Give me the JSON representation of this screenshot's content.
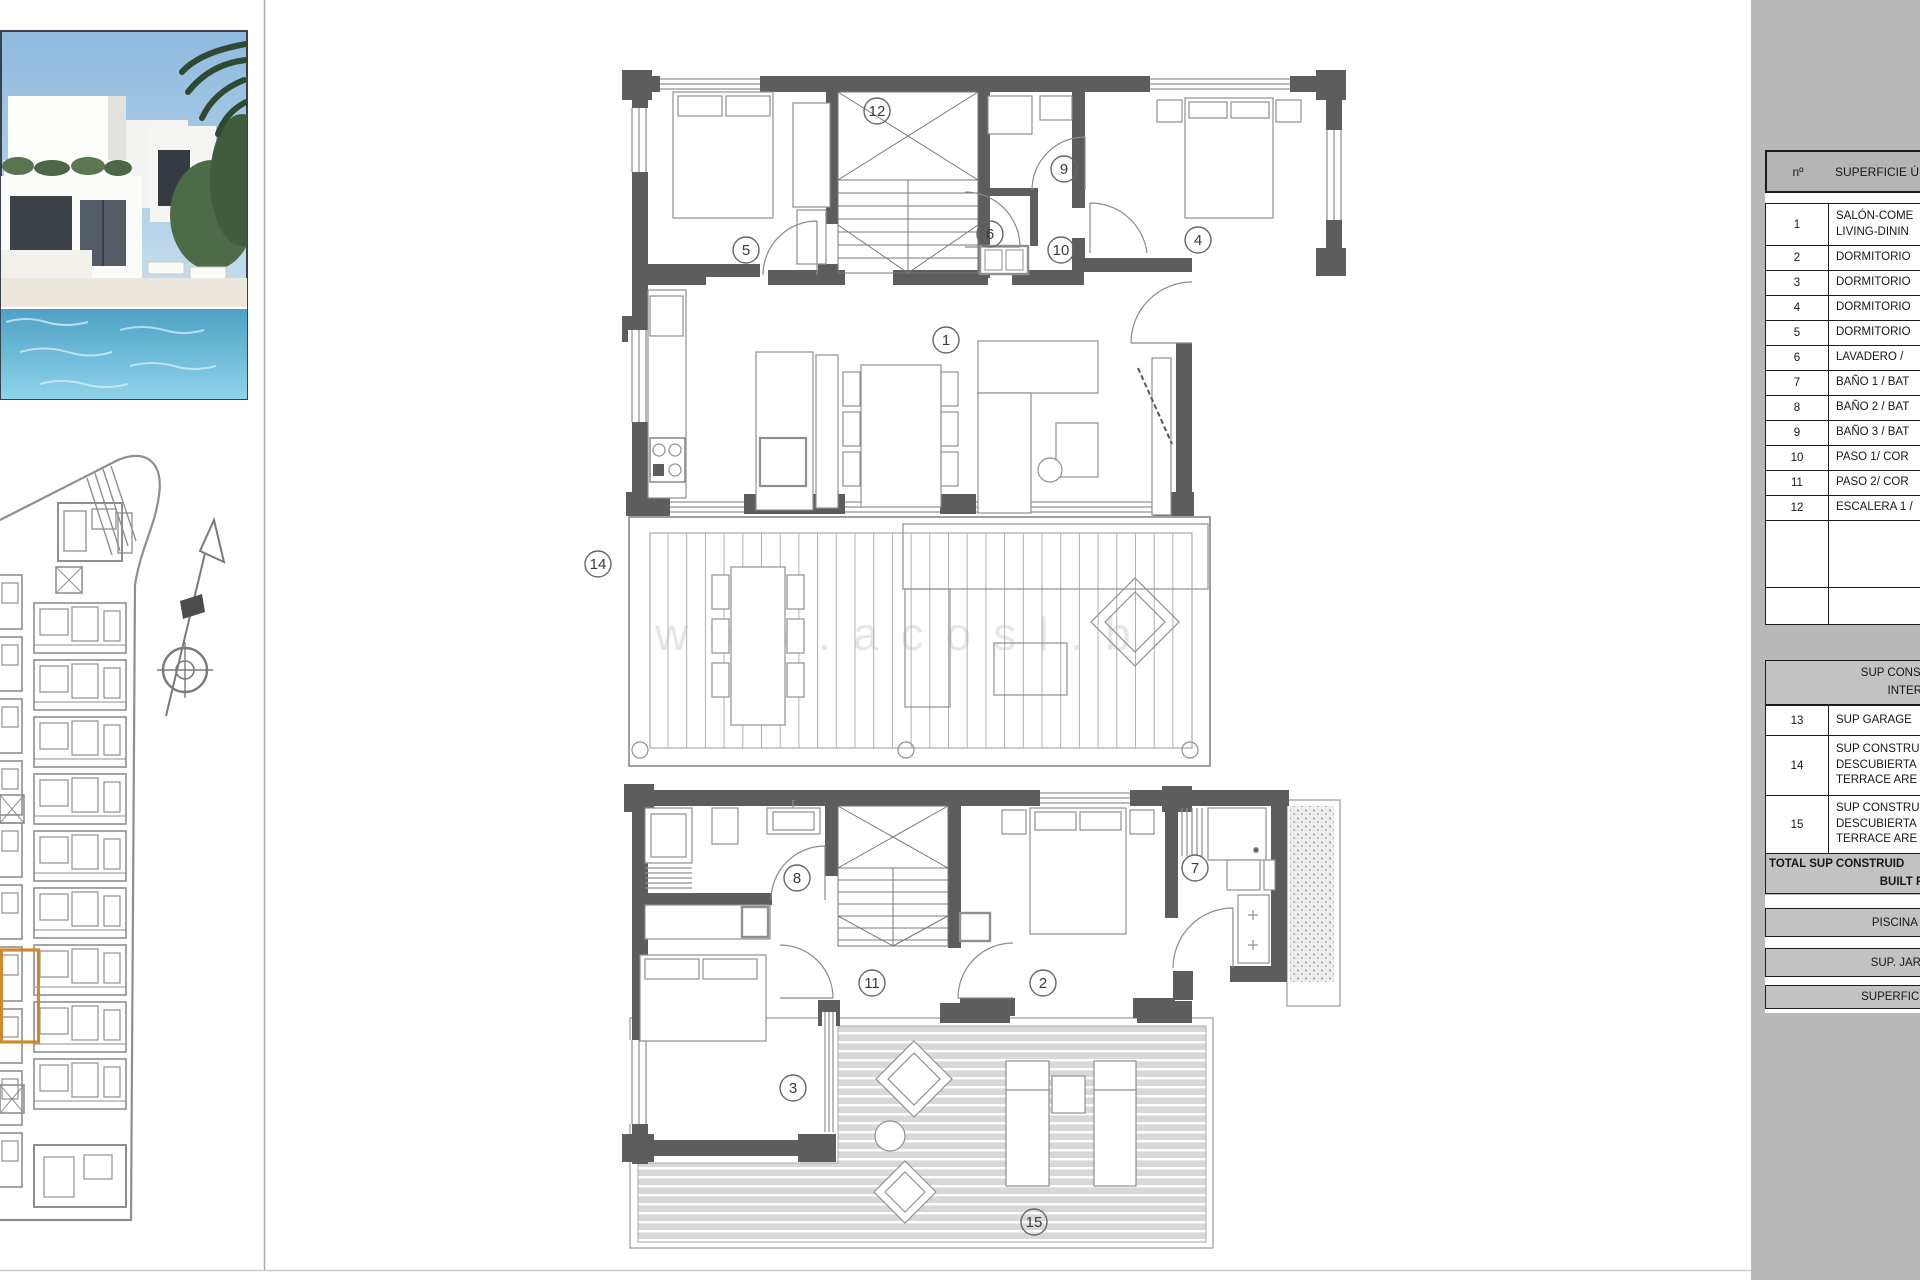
{
  "panel": {
    "table": {
      "header": {
        "num": "nº",
        "label": "SUPERFICIE Ú"
      },
      "rows1": [
        {
          "num": "1",
          "lines": [
            "SALÓN-COME",
            "LIVING-DININ"
          ]
        },
        {
          "num": "2",
          "lines": [
            "DORMITORIO"
          ]
        },
        {
          "num": "3",
          "lines": [
            "DORMITORIO"
          ]
        },
        {
          "num": "4",
          "lines": [
            "DORMITORIO"
          ]
        },
        {
          "num": "5",
          "lines": [
            "DORMITORIO"
          ]
        },
        {
          "num": "6",
          "lines": [
            "LAVADERO /"
          ]
        },
        {
          "num": "7",
          "lines": [
            "BAÑO 1 / BAT"
          ]
        },
        {
          "num": "8",
          "lines": [
            "BAÑO 2 / BAT"
          ]
        },
        {
          "num": "9",
          "lines": [
            "BAÑO 3 / BAT"
          ]
        },
        {
          "num": "10",
          "lines": [
            "PASO 1/ COR"
          ]
        },
        {
          "num": "11",
          "lines": [
            "PASO 2/ COR"
          ]
        },
        {
          "num": "12",
          "lines": [
            "ESCALERA 1 /"
          ]
        }
      ],
      "section_header": [
        "SUP CONSTRUIDA I",
        "INTERIOR"
      ],
      "rows2": [
        {
          "num": "13",
          "lines": [
            "SUP GARAGE"
          ]
        },
        {
          "num": "14",
          "lines": [
            "SUP CONSTRU",
            "DESCUBIERTA",
            "TERRACE ARE"
          ]
        },
        {
          "num": "15",
          "lines": [
            "SUP CONSTRU",
            "DESCUBIERTA",
            "TERRACE ARE"
          ]
        }
      ],
      "total": [
        "TOTAL SUP CONSTRUID",
        "BUILT PRIVA"
      ],
      "bands": [
        "PISCINA / SWIM",
        "SUP. JARDÍN / G",
        "SUPERFICE PARCE"
      ]
    }
  },
  "plans": {
    "room_labels": [
      {
        "n": "5",
        "x": 746,
        "y": 250
      },
      {
        "n": "12",
        "x": 877,
        "y": 111
      },
      {
        "n": "9",
        "x": 1064,
        "y": 169
      },
      {
        "n": "6",
        "x": 990,
        "y": 234
      },
      {
        "n": "10",
        "x": 1061,
        "y": 250
      },
      {
        "n": "4",
        "x": 1198,
        "y": 240
      },
      {
        "n": "1",
        "x": 946,
        "y": 340
      },
      {
        "n": "14",
        "x": 598,
        "y": 564
      },
      {
        "n": "8",
        "x": 797,
        "y": 878
      },
      {
        "n": "7",
        "x": 1195,
        "y": 868
      },
      {
        "n": "11",
        "x": 872,
        "y": 983
      },
      {
        "n": "2",
        "x": 1043,
        "y": 983
      },
      {
        "n": "3",
        "x": 793,
        "y": 1088
      },
      {
        "n": "15",
        "x": 1034,
        "y": 1222
      }
    ]
  },
  "watermark": "www.acosl.b",
  "colors": {
    "panel_gray": "#b9b9b9",
    "band_gray": "#c2c2c2",
    "wall_gray": "#5d5d5d",
    "highlight_orange": "#cd8a33"
  }
}
